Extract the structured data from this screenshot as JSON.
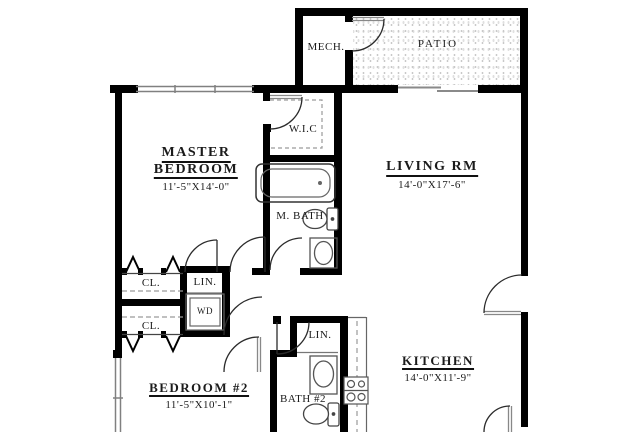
{
  "plan": {
    "type": "apartment-floor-plan",
    "rooms": {
      "mech": {
        "label": "MECH."
      },
      "patio": {
        "label": "PATIO"
      },
      "wic": {
        "label": "W.I.C"
      },
      "master_bedroom": {
        "line1": "MASTER",
        "line2": "BEDROOM",
        "dims": "11'-5\"X14'-0\""
      },
      "living_rm": {
        "label": "LIVING RM",
        "dims": "14'-0\"X17'-6\""
      },
      "m_bath": {
        "label": "M. BATH"
      },
      "closet_top": {
        "label": "CL."
      },
      "closet_bottom": {
        "label": "CL."
      },
      "linen_hall": {
        "label": "LIN."
      },
      "washer_dryer": {
        "label": "WD"
      },
      "linen_bath2": {
        "label": "LIN."
      },
      "bath_2": {
        "label": "BATH #2"
      },
      "bedroom_2": {
        "label": "BEDROOM #2",
        "dims": "11'-5\"X10'-1\""
      },
      "kitchen": {
        "label": "KITCHEN",
        "dims": "14'-0\"X11'-9\""
      }
    },
    "fixtures": [
      "bathtub",
      "toilet",
      "vanity-sink",
      "washer-dryer",
      "cooktop",
      "kitchen-counter",
      "sliding-glass-door",
      "window",
      "door-swing",
      "bifold-closet-door"
    ],
    "colors": {
      "wall": "#000000",
      "text": "#1b1b1b",
      "fixture_outline": "#555555",
      "door_arc": "#2b2b2b",
      "dashed_line": "#9a9a9a",
      "patio_dot": "#c9c9c9",
      "window_line": "#808080"
    }
  }
}
